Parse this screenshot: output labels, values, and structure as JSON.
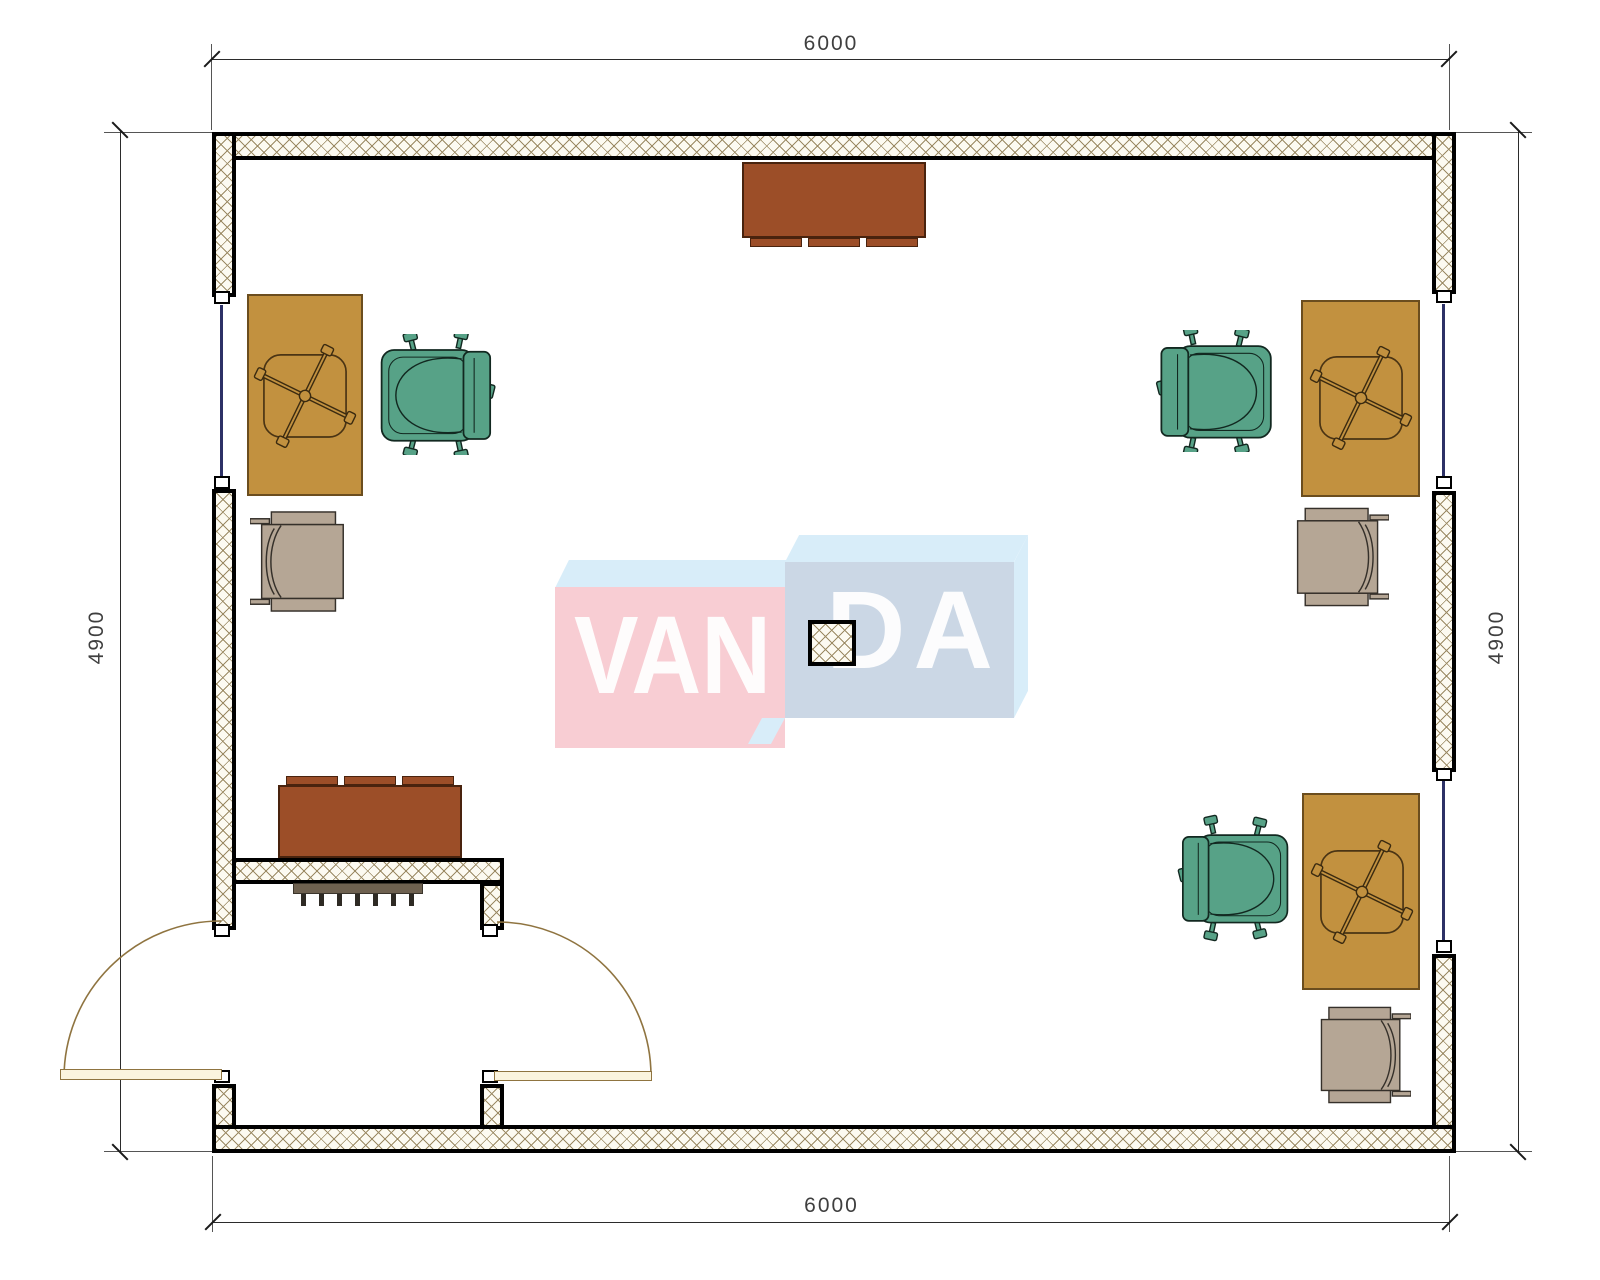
{
  "plan": {
    "title": "office room floor plan",
    "dimensions": {
      "top": {
        "label": "6000"
      },
      "bottom": {
        "label": "6000"
      },
      "left": {
        "label": "4900"
      },
      "right": {
        "label": "4900"
      }
    },
    "watermark": {
      "full_text": "VANDA",
      "text_left": "VAN",
      "text_right": "DA",
      "box_left_color": "#F8CDD3",
      "box_right_color": "#CBD7E5",
      "box_top_color": "#D8EDF9",
      "text_color": "#FFFFFF"
    },
    "palette": {
      "wall_edge": "#000000",
      "wall_hatch": "#9B8A64",
      "desk": "#C2913F",
      "cabinet": "#9C4E28",
      "task_chair_green": "#57A287",
      "guest_chair_taupe": "#B5A695",
      "door_leaf": "#FBF4DE",
      "door_arc": "#8F7440",
      "window_glazing": "#2D3166",
      "dimension_text": "#3F3F3F"
    },
    "contents": {
      "desks": 3,
      "desk_chair_base_symbols": 3,
      "green_task_chairs": 3,
      "taupe_guest_chairs": 3,
      "cabinets": 2,
      "radiators": 1,
      "columns": 1,
      "entrance_door_leaves": 2,
      "windows": 3
    }
  }
}
